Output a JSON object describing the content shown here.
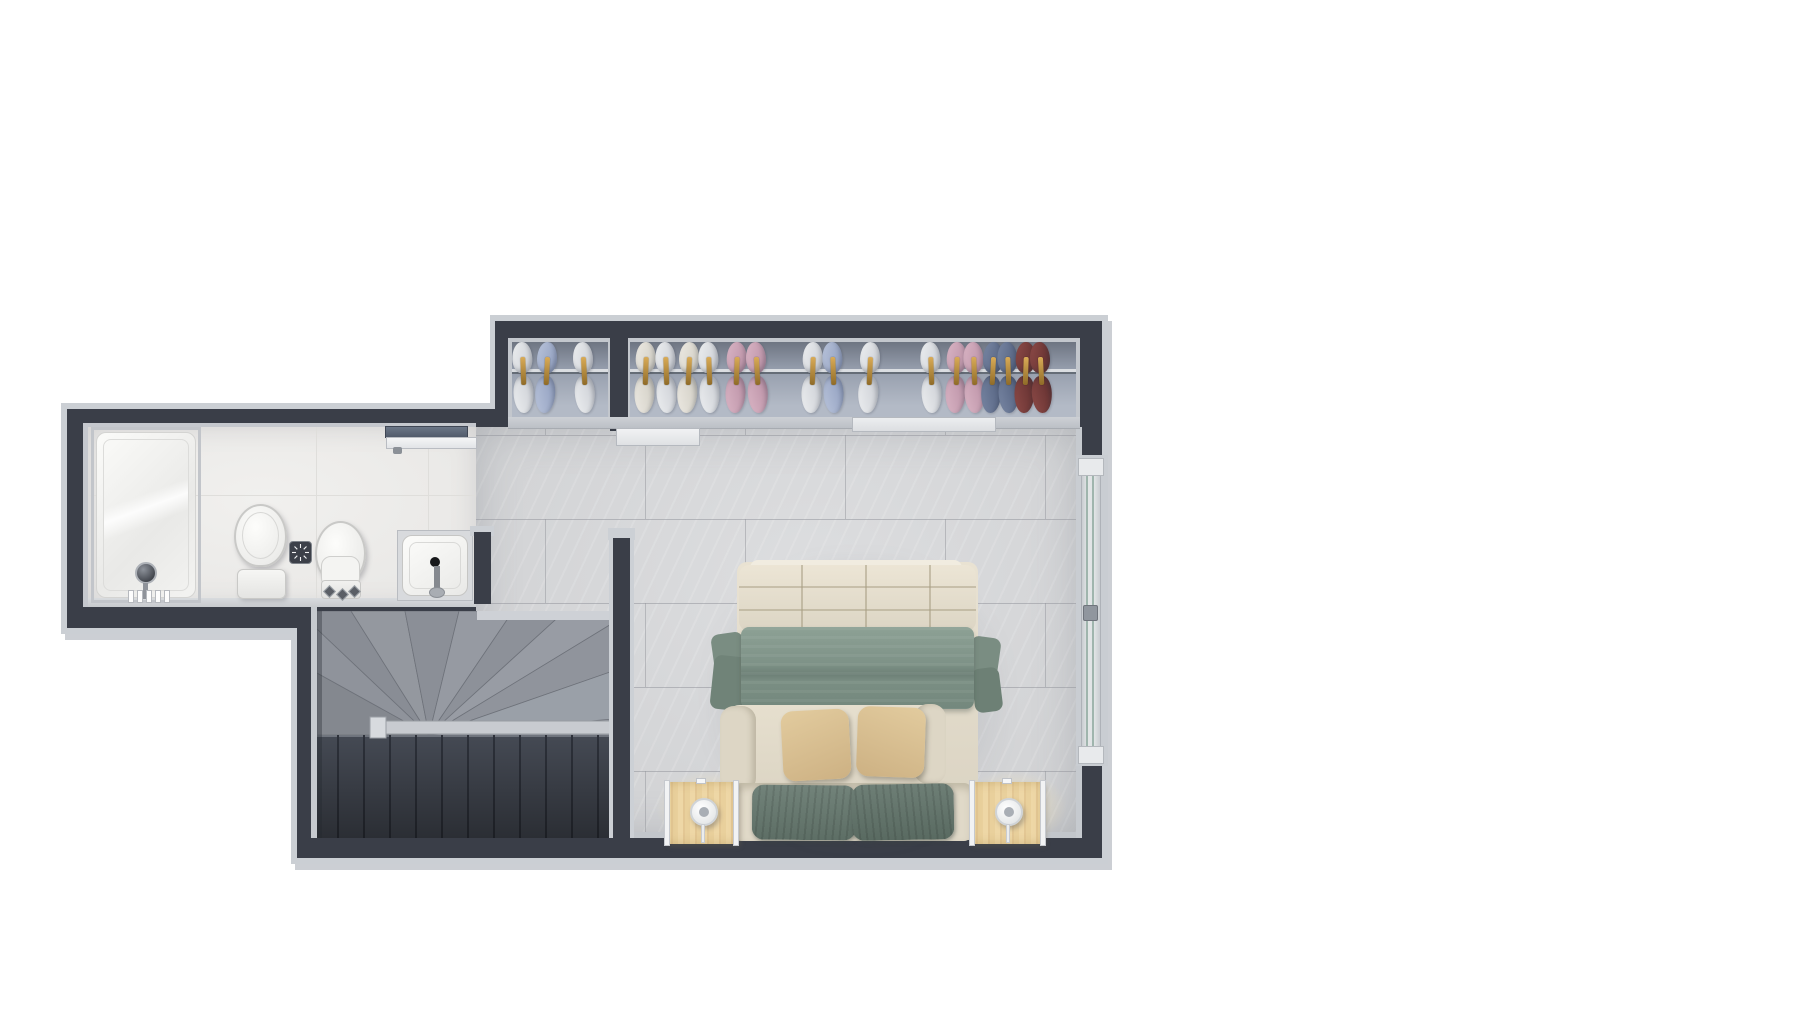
{
  "scene": {
    "description": "3D rendered top-down architectural floor plan of a bedroom suite",
    "view": "top-down orthographic render",
    "background": "#ffffff"
  },
  "palette": {
    "wall_dark": "#3a3e48",
    "wall_edge_light": "#cbcfd4",
    "bedroom_tile": "#d6d7d9",
    "bathroom_tile": "#edecea",
    "closet_floor": "#97a0ae",
    "stair_fan": "#8e929a",
    "stair_flight_dark": "#454a54",
    "blanket_green": "#7e9287",
    "pillow_tan": "#d8c095",
    "bed_cream": "#e3dccb",
    "nightstand_wood": "#ead2a0",
    "hanger_gold": "#c3923e",
    "window_glass": "#9fb5ad"
  },
  "rooms": [
    {
      "id": "bathroom",
      "fixtures": [
        "shower",
        "toilet",
        "bidet",
        "floor-drain",
        "sink",
        "sliding-door"
      ]
    },
    {
      "id": "walk-in-closet",
      "sections": 2,
      "garment_count": 19,
      "sliding_doors": 2
    },
    {
      "id": "bedroom",
      "furniture": [
        "double-bed",
        "nightstand-left",
        "nightstand-right",
        "table-lamp-left",
        "table-lamp-right"
      ],
      "window_panes": 2
    },
    {
      "id": "staircase",
      "type": "winder",
      "handrail": true
    }
  ],
  "garment_colors": {
    "white": [
      "#eceef0",
      "#c9ccd2"
    ],
    "cream": [
      "#ece9e2",
      "#cfccc2"
    ],
    "lightblue": [
      "#b8c3da",
      "#8e9cbd"
    ],
    "pink": [
      "#d9b4c4",
      "#b98fa4"
    ],
    "navy": [
      "#7886a3",
      "#515f7d"
    ],
    "maroon": [
      "#8d4a47",
      "#5f2e2e"
    ]
  },
  "closet": {
    "rail_y": 369,
    "garments": [
      {
        "x": 523,
        "color": "white",
        "rot": -2
      },
      {
        "x": 546,
        "color": "lightblue",
        "rot": 3
      },
      {
        "x": 584,
        "color": "white",
        "rot": -3
      },
      {
        "x": 645,
        "color": "cream",
        "rot": 2
      },
      {
        "x": 666,
        "color": "white",
        "rot": -2
      },
      {
        "x": 688,
        "color": "cream",
        "rot": 3
      },
      {
        "x": 709,
        "color": "white",
        "rot": -2
      },
      {
        "x": 736,
        "color": "pink",
        "rot": 2
      },
      {
        "x": 757,
        "color": "pink",
        "rot": -3
      },
      {
        "x": 812,
        "color": "white",
        "rot": 2
      },
      {
        "x": 833,
        "color": "lightblue",
        "rot": -2
      },
      {
        "x": 869,
        "color": "white",
        "rot": 3
      },
      {
        "x": 931,
        "color": "white",
        "rot": -2
      },
      {
        "x": 956,
        "color": "pink",
        "rot": 2
      },
      {
        "x": 974,
        "color": "pink",
        "rot": -2
      },
      {
        "x": 992,
        "color": "navy",
        "rot": 3
      },
      {
        "x": 1008,
        "color": "navy",
        "rot": -2
      },
      {
        "x": 1025,
        "color": "maroon",
        "rot": 2
      },
      {
        "x": 1041,
        "color": "maroon",
        "rot": -3
      }
    ]
  },
  "stairs": {
    "left": 317,
    "top": 611,
    "width": 296,
    "height": 227,
    "fan_apex": [
      112,
      124
    ],
    "fan_points": [
      [
        0,
        124
      ],
      [
        0,
        62
      ],
      [
        0,
        18
      ],
      [
        34,
        0
      ],
      [
        88,
        0
      ],
      [
        142,
        0
      ],
      [
        196,
        0
      ],
      [
        248,
        0
      ],
      [
        296,
        12
      ],
      [
        296,
        60
      ],
      [
        296,
        108
      ]
    ],
    "fan_fills": [
      "#84888f",
      "#8f939b",
      "#898d95",
      "#94989f",
      "#8b8f97",
      "#969aa2",
      "#8d9199",
      "#989ca4",
      "#90949c",
      "#9aa0a8"
    ],
    "flight_y": 124,
    "riser_xs": [
      20,
      46,
      72,
      98,
      124,
      150,
      176,
      202,
      228,
      254,
      280
    ],
    "sill": {
      "x": 160,
      "y": 0,
      "w": 136,
      "h": 9
    },
    "rail": {
      "x": 58,
      "y": 110,
      "w": 236,
      "h": 13
    },
    "newel": {
      "x": 53,
      "y": 106,
      "w": 16,
      "h": 21
    }
  },
  "bedroom_floor": {
    "rect": {
      "left": 476,
      "top": 427,
      "width": 602,
      "height": 411
    },
    "grout": {
      "h_lines": [
        435,
        519,
        603,
        687,
        771
      ],
      "v_spacing": 200,
      "v_offsets": [
        69,
        169
      ]
    }
  }
}
